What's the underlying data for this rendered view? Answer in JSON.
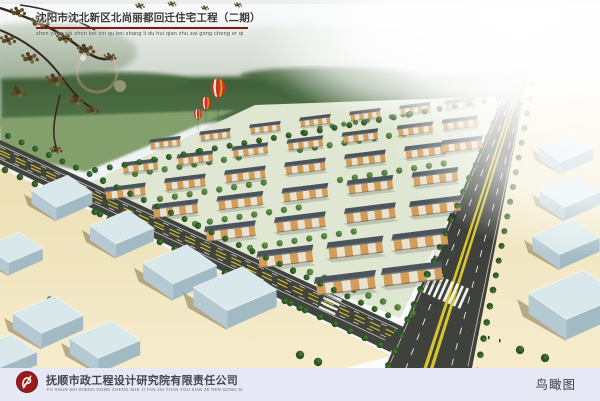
{
  "header": {
    "title": "沈阳市沈北新区北尚丽都回迁住宅工程（二期）",
    "pinyin": "shen yang shi shen bei xin qu bei shang li du hui qian zhu zai gong cheng er qi",
    "underline_color": "#821c11"
  },
  "scene": {
    "kind": "aerial architectural rendering",
    "elements": [
      "apartment-building-rows",
      "tree-lined-roads",
      "main-road-with-yellow-lines",
      "crosswalks",
      "warehouse-boxes",
      "hot-air-balloons",
      "foreground-tree-branches",
      "distant-treeline",
      "haze"
    ],
    "colors": {
      "sky": "#eef2f3",
      "treeline": "#3f5f38",
      "ground_beige": "#f0e4bd",
      "road_asphalt": "#41443d",
      "road_line_yellow": "#d6c52f",
      "building_roof": "#4b545b",
      "building_facade": "#d39c58",
      "warehouse_blue": "#c3d6dd",
      "tree_green": "#3e6b2d"
    }
  },
  "footer": {
    "company": "抚顺市政工程设计研究院有限责任公司",
    "company_pinyin": "FU SHUN SHI ZHENG GONG CHENG SHE JI YAN JIU YUAN YOU XIAN ZE REN GONG SI",
    "caption": "鸟瞰图",
    "bar_color": "#e6e8f5",
    "logo_color": "#9a1b1b"
  }
}
